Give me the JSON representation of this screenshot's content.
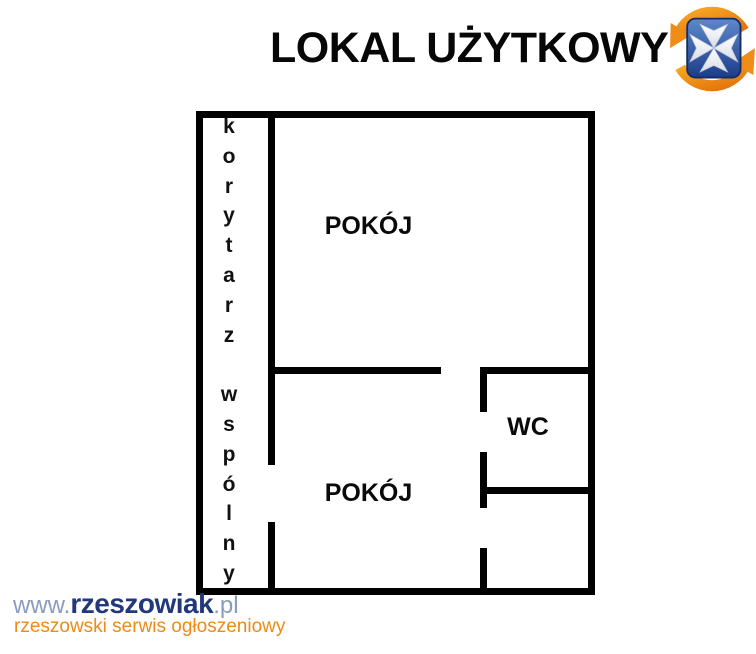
{
  "title": "LOKAL UŻYTKOWY",
  "logo": {
    "name": "rzeszowiak-logo",
    "shield_color": "#2b55a4",
    "shield_dark": "#16307a",
    "cross_color": "#f7f7f7",
    "swirl_color": "#f09a1f",
    "swirl_dark": "#e06a10"
  },
  "floor_plan": {
    "corridor_letters": "k\no\nr\ny\nt\na\nr\nz\n\nw\ns\np\nó\nl\nn\ny",
    "corridor_words": "korytarz wspólny",
    "room_top_label": "POKÓJ",
    "room_bottom_label": "POKÓJ",
    "wc_label": "WC",
    "wall_color": "#000000"
  },
  "watermark": {
    "url_prefix": "www.",
    "url_name": "rzeszowiak",
    "url_suffix": ".pl",
    "tagline": "rzeszowski serwis ogłoszeniowy",
    "name_color": "#21397b",
    "muted_color": "#8b9bbd",
    "tagline_color": "#ee8a15"
  }
}
